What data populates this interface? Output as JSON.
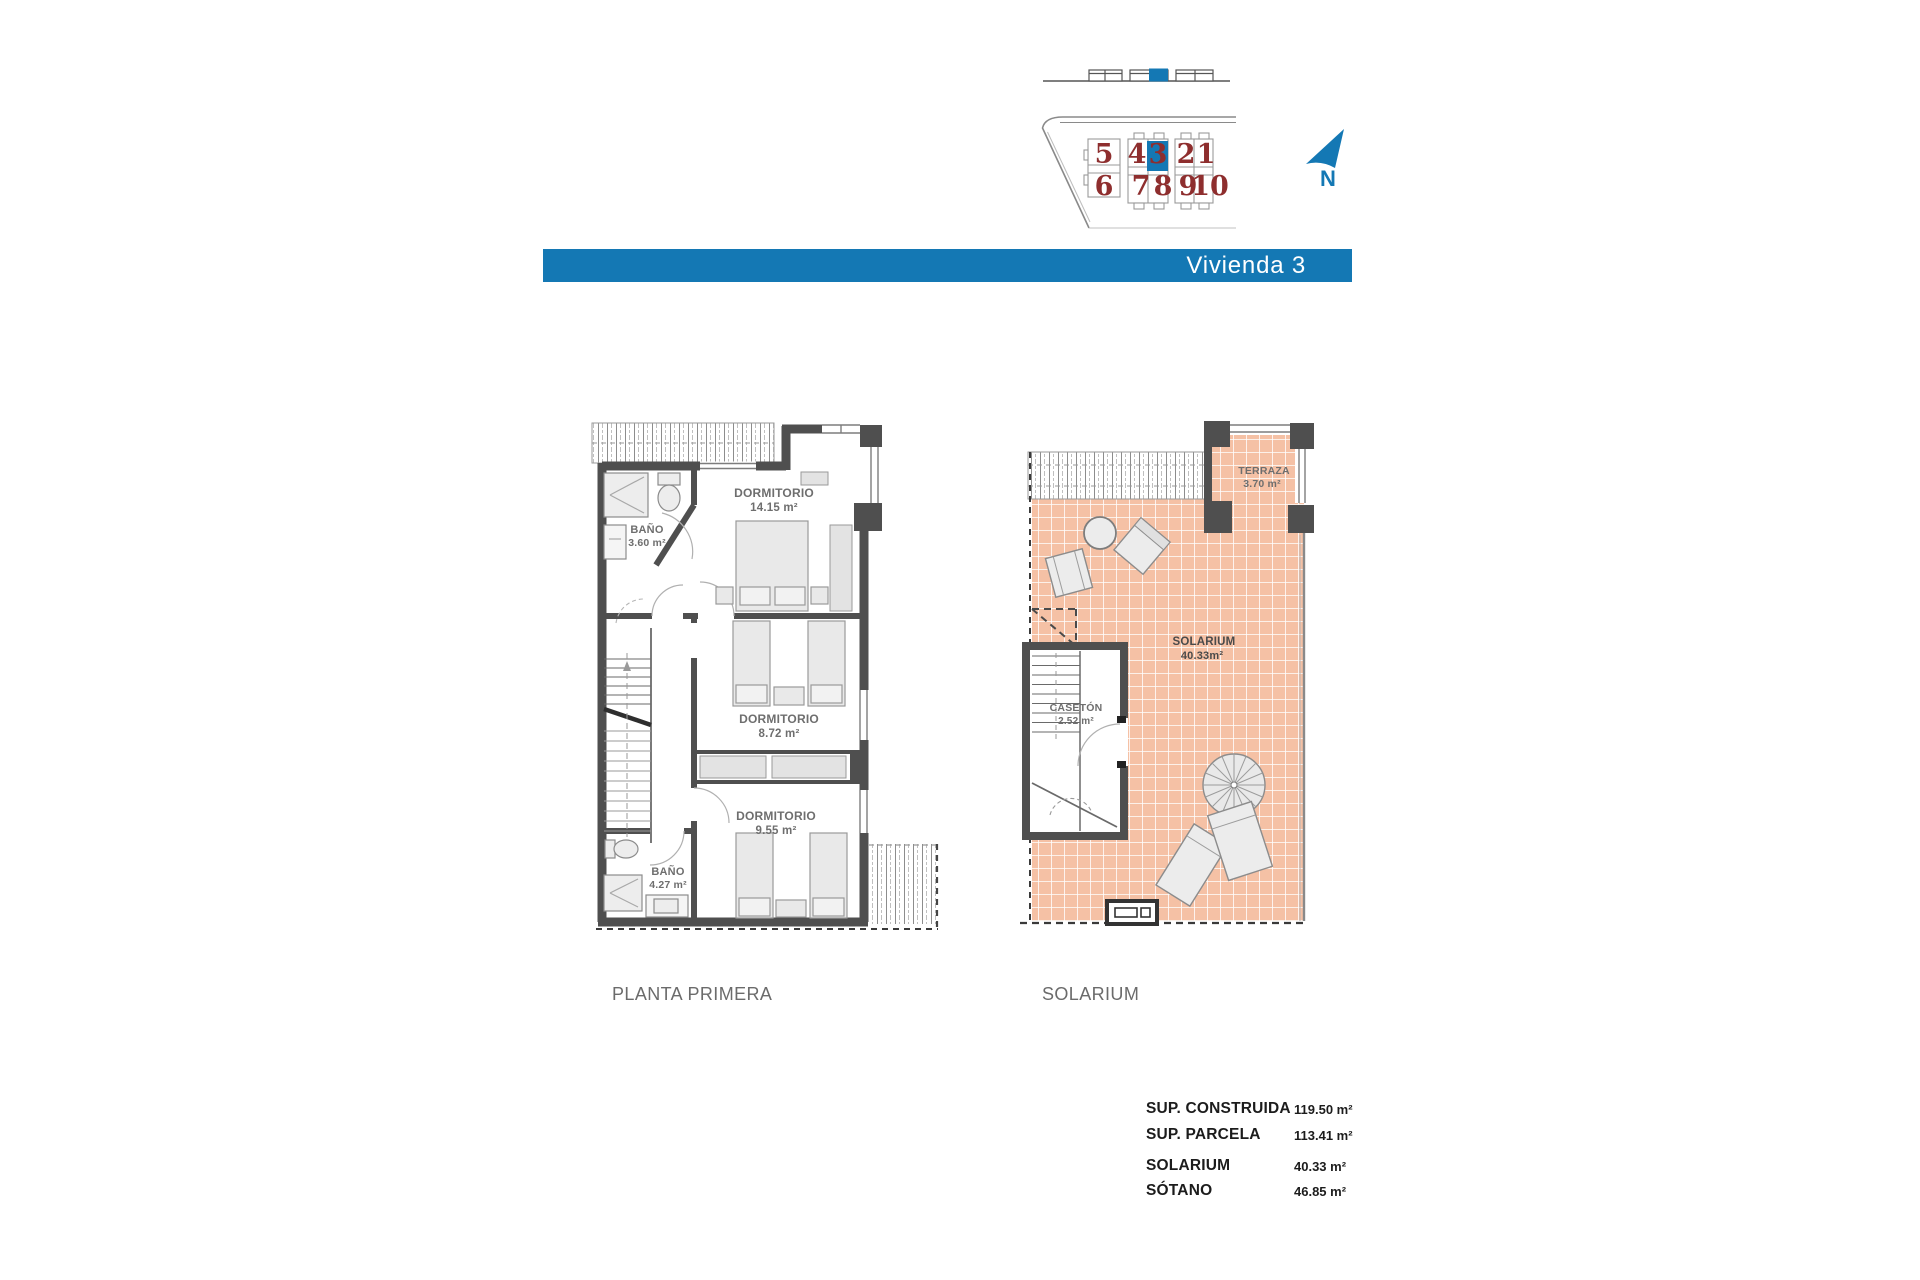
{
  "colors": {
    "accent": "#1478b4",
    "unit_number_red": "#8e2e2e",
    "tile_salmon": "#f5c1a5",
    "wall_gray": "#4f4f4f"
  },
  "header": {
    "title": "Vivienda 3"
  },
  "site_map": {
    "row1": [
      "5",
      "4",
      "3",
      "2",
      "1"
    ],
    "row2": [
      "6",
      "7",
      "8",
      "9",
      "10"
    ],
    "highlighted_unit": "3",
    "north_label": "N"
  },
  "floor_plan": {
    "name": "PLANTA PRIMERA",
    "bano1_label": "BAÑO",
    "bano1_area": "3.60 m²",
    "dorm1_label": "DORMITORIO",
    "dorm1_area": "14.15 m²",
    "dorm2_label": "DORMITORIO",
    "dorm2_area": "8.72 m²",
    "dorm3_label": "DORMITORIO",
    "dorm3_area": "9.55 m²",
    "bano2_label": "BAÑO",
    "bano2_area": "4.27 m²"
  },
  "solarium_plan": {
    "name": "SOLARIUM",
    "terraza_label": "TERRAZA",
    "terraza_area": "3.70 m²",
    "solarium_label": "SOLARIUM",
    "solarium_area": "40.33m²",
    "caseton_label": "CASETÓN",
    "caseton_area": "2.52 m²"
  },
  "summary": {
    "rows": [
      {
        "label": "SUP. CONSTRUIDA",
        "value": "119.50 m²"
      },
      {
        "label": "SUP. PARCELA",
        "value": "113.41 m²"
      },
      {
        "label": "SOLARIUM",
        "value": "40.33 m²"
      },
      {
        "label": "SÓTANO",
        "value": "46.85 m²"
      }
    ]
  }
}
